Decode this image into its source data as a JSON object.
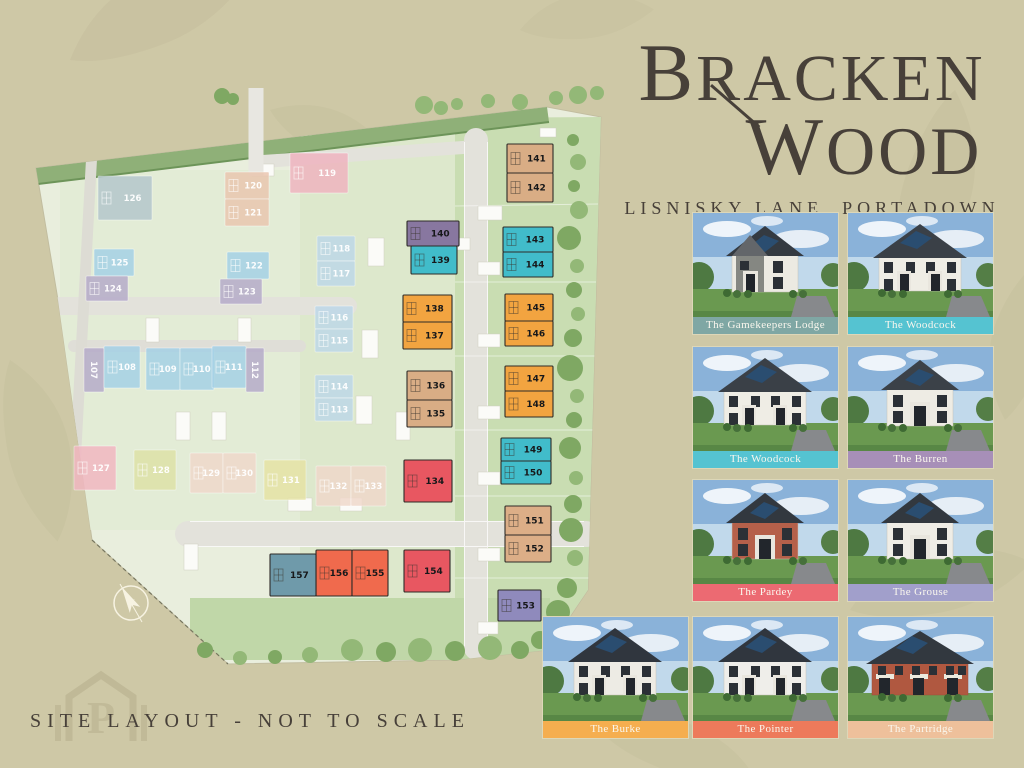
{
  "title": {
    "line1": "BRACKEN",
    "line2": "WOOD",
    "subtitle": "LISNISKY LANE, PORTADOWN"
  },
  "footer": {
    "note": "SITE LAYOUT - NOT TO SCALE"
  },
  "compass": {
    "label": "N"
  },
  "watermark": {
    "letter": "P"
  },
  "colors": {
    "background": "#cec8a6",
    "ink": "#474039"
  },
  "house_cards": [
    {
      "name": "The Gamekeepers Lodge",
      "row": 0,
      "col": 0,
      "label_color": "#7fa7a4",
      "house": {
        "type": "stone-detached",
        "wall": "#eceae2",
        "stone": "#858782",
        "roof": "#343a41"
      }
    },
    {
      "name": "The Woodcock",
      "row": 0,
      "col": 1,
      "label_color": "#55c3d1",
      "house": {
        "type": "semi",
        "wall": "#efede5",
        "roof": "#3a4047"
      }
    },
    {
      "name": "The Woodcock",
      "row": 1,
      "col": 0,
      "label_color": "#55c3d1",
      "house": {
        "type": "semi",
        "wall": "#efede5",
        "roof": "#3a4047"
      }
    },
    {
      "name": "The Burren",
      "row": 1,
      "col": 1,
      "label_color": "#a78fb8",
      "house": {
        "type": "detached",
        "wall": "#eeece4",
        "roof": "#3b4148"
      }
    },
    {
      "name": "The Pardey",
      "row": 2,
      "col": 0,
      "label_color": "#ec6a72",
      "house": {
        "type": "detached",
        "wall": "#b5604a",
        "roof": "#32383f"
      }
    },
    {
      "name": "The Grouse",
      "row": 2,
      "col": 1,
      "label_color": "#a19fcb",
      "house": {
        "type": "detached",
        "wall": "#efede6",
        "roof": "#32383f"
      }
    },
    {
      "name": "The Burke",
      "row": 3,
      "col": 0,
      "label_color": "#f5ae4f",
      "house": {
        "type": "semi",
        "wall": "#edebe4",
        "roof": "#30363e"
      }
    },
    {
      "name": "The Pointer",
      "row": 3,
      "col": 1,
      "label_color": "#ed7a5b",
      "house": {
        "type": "semi",
        "wall": "#efeeea",
        "roof": "#30363e"
      }
    },
    {
      "name": "The Partridge",
      "row": 3,
      "col": 2,
      "label_color": "#eec09b",
      "house": {
        "type": "terrace",
        "wall": "#b05840",
        "roof": "#32383f"
      }
    }
  ],
  "site_plan": {
    "available_plots": [
      {
        "num": "140",
        "x": 407,
        "y": 221,
        "w": 52,
        "h": 25,
        "color": "#8877a0"
      },
      {
        "num": "139",
        "x": 411,
        "y": 246,
        "w": 46,
        "h": 28,
        "color": "#41bcca"
      },
      {
        "num": "138",
        "x": 403,
        "y": 295,
        "w": 49,
        "h": 27,
        "color": "#f2a440"
      },
      {
        "num": "137",
        "x": 403,
        "y": 322,
        "w": 49,
        "h": 27,
        "color": "#f2a440"
      },
      {
        "num": "136",
        "x": 407,
        "y": 371,
        "w": 45,
        "h": 29,
        "color": "#d9ad85"
      },
      {
        "num": "135",
        "x": 407,
        "y": 400,
        "w": 45,
        "h": 27,
        "color": "#d9ad85"
      },
      {
        "num": "141",
        "x": 507,
        "y": 144,
        "w": 46,
        "h": 29,
        "color": "#d9ad85"
      },
      {
        "num": "142",
        "x": 507,
        "y": 173,
        "w": 46,
        "h": 29,
        "color": "#d9ad85"
      },
      {
        "num": "143",
        "x": 503,
        "y": 227,
        "w": 50,
        "h": 25,
        "color": "#41bcca"
      },
      {
        "num": "144",
        "x": 503,
        "y": 252,
        "w": 50,
        "h": 25,
        "color": "#41bcca"
      },
      {
        "num": "145",
        "x": 505,
        "y": 294,
        "w": 48,
        "h": 27,
        "color": "#f2a440"
      },
      {
        "num": "146",
        "x": 505,
        "y": 321,
        "w": 48,
        "h": 25,
        "color": "#f2a440"
      },
      {
        "num": "147",
        "x": 505,
        "y": 366,
        "w": 48,
        "h": 25,
        "color": "#f2a440"
      },
      {
        "num": "148",
        "x": 505,
        "y": 391,
        "w": 48,
        "h": 26,
        "color": "#f2a440"
      },
      {
        "num": "149",
        "x": 501,
        "y": 438,
        "w": 50,
        "h": 23,
        "color": "#41bcca"
      },
      {
        "num": "150",
        "x": 501,
        "y": 461,
        "w": 50,
        "h": 23,
        "color": "#41bcca"
      },
      {
        "num": "151",
        "x": 505,
        "y": 506,
        "w": 46,
        "h": 29,
        "color": "#dcae87"
      },
      {
        "num": "152",
        "x": 505,
        "y": 535,
        "w": 46,
        "h": 27,
        "color": "#dcae87"
      },
      {
        "num": "153",
        "x": 498,
        "y": 590,
        "w": 43,
        "h": 31,
        "color": "#8f8abc"
      },
      {
        "num": "134",
        "x": 404,
        "y": 460,
        "w": 48,
        "h": 42,
        "color": "#e85761"
      },
      {
        "num": "154",
        "x": 404,
        "y": 550,
        "w": 46,
        "h": 42,
        "color": "#e85761"
      },
      {
        "num": "156",
        "x": 316,
        "y": 550,
        "w": 36,
        "h": 46,
        "color": "#f06a4d"
      },
      {
        "num": "155",
        "x": 352,
        "y": 550,
        "w": 36,
        "h": 46,
        "color": "#f06a4d"
      },
      {
        "num": "157",
        "x": 270,
        "y": 554,
        "w": 46,
        "h": 42,
        "color": "#6f9aaa"
      }
    ],
    "muted_plots": [
      {
        "num": "126",
        "x": 98,
        "y": 176,
        "w": 54,
        "h": 44,
        "color": "#b3c6cc"
      },
      {
        "num": "120",
        "x": 225,
        "y": 172,
        "w": 44,
        "h": 27,
        "color": "#eac5ae"
      },
      {
        "num": "121",
        "x": 225,
        "y": 199,
        "w": 44,
        "h": 27,
        "color": "#eac5ae"
      },
      {
        "num": "119",
        "x": 290,
        "y": 153,
        "w": 58,
        "h": 40,
        "color": "#f0b3bf"
      },
      {
        "num": "125",
        "x": 94,
        "y": 249,
        "w": 40,
        "h": 27,
        "color": "#a3d0e6"
      },
      {
        "num": "124",
        "x": 86,
        "y": 276,
        "w": 42,
        "h": 25,
        "color": "#b4a9c9"
      },
      {
        "num": "122",
        "x": 227,
        "y": 252,
        "w": 42,
        "h": 27,
        "color": "#a3d0e6"
      },
      {
        "num": "123",
        "x": 220,
        "y": 279,
        "w": 42,
        "h": 25,
        "color": "#b4a9c9"
      },
      {
        "num": "118",
        "x": 317,
        "y": 236,
        "w": 38,
        "h": 25,
        "color": "#bdd8e9"
      },
      {
        "num": "117",
        "x": 317,
        "y": 261,
        "w": 38,
        "h": 25,
        "color": "#bdd8e9"
      },
      {
        "num": "116",
        "x": 315,
        "y": 306,
        "w": 38,
        "h": 23,
        "color": "#bdd8e9"
      },
      {
        "num": "115",
        "x": 315,
        "y": 329,
        "w": 38,
        "h": 23,
        "color": "#bdd8e9"
      },
      {
        "num": "114",
        "x": 315,
        "y": 375,
        "w": 38,
        "h": 23,
        "color": "#bdd8e9"
      },
      {
        "num": "113",
        "x": 315,
        "y": 398,
        "w": 38,
        "h": 23,
        "color": "#bdd8e9"
      },
      {
        "num": "107",
        "x": 84,
        "y": 348,
        "w": 20,
        "h": 44,
        "color": "#b4a9c9",
        "vert": true
      },
      {
        "num": "108",
        "x": 104,
        "y": 346,
        "w": 36,
        "h": 42,
        "color": "#a3d0e6"
      },
      {
        "num": "109",
        "x": 146,
        "y": 348,
        "w": 34,
        "h": 42,
        "color": "#a3d0e6"
      },
      {
        "num": "110",
        "x": 180,
        "y": 348,
        "w": 34,
        "h": 42,
        "color": "#a3d0e6"
      },
      {
        "num": "111",
        "x": 212,
        "y": 346,
        "w": 34,
        "h": 42,
        "color": "#a3d0e6"
      },
      {
        "num": "112",
        "x": 246,
        "y": 348,
        "w": 18,
        "h": 44,
        "color": "#b4a9c9",
        "vert": true
      },
      {
        "num": "127",
        "x": 74,
        "y": 446,
        "w": 42,
        "h": 44,
        "color": "#f2b6c1"
      },
      {
        "num": "128",
        "x": 134,
        "y": 450,
        "w": 42,
        "h": 40,
        "color": "#dde2a6"
      },
      {
        "num": "129",
        "x": 190,
        "y": 453,
        "w": 33,
        "h": 40,
        "color": "#f0d8ca"
      },
      {
        "num": "130",
        "x": 223,
        "y": 453,
        "w": 33,
        "h": 40,
        "color": "#f0d8ca"
      },
      {
        "num": "131",
        "x": 264,
        "y": 460,
        "w": 42,
        "h": 40,
        "color": "#e6e3a3"
      },
      {
        "num": "132",
        "x": 316,
        "y": 466,
        "w": 35,
        "h": 40,
        "color": "#f0d8ca"
      },
      {
        "num": "133",
        "x": 351,
        "y": 466,
        "w": 35,
        "h": 40,
        "color": "#f0d8ca"
      }
    ]
  }
}
